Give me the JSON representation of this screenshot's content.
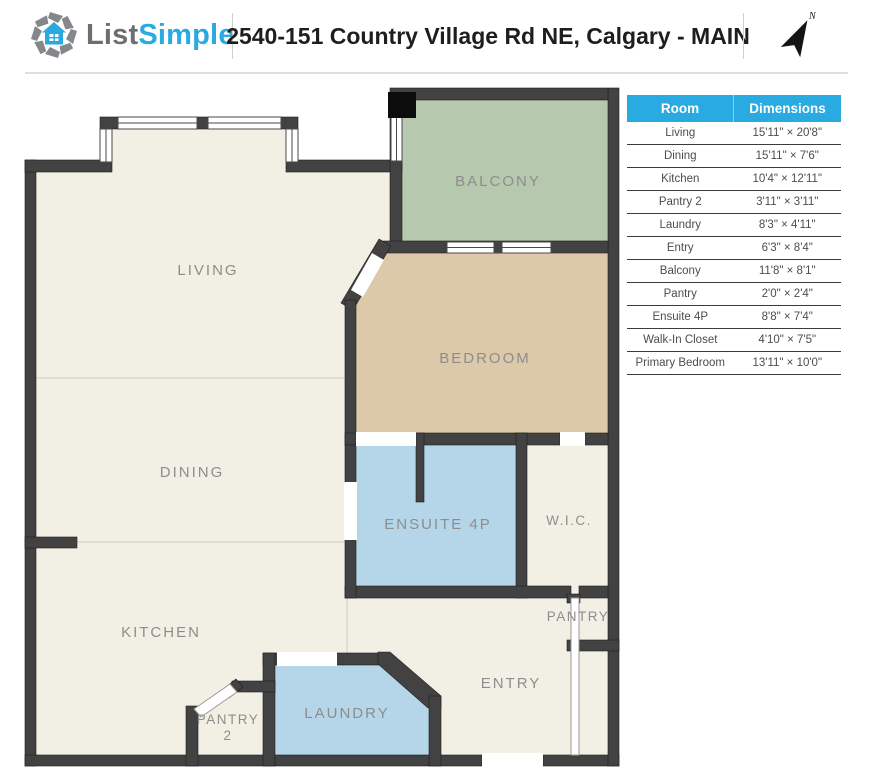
{
  "theme": {
    "accent": "#29abe2",
    "wall": "#424242",
    "floor": "#f2efe5",
    "bedroomcol": "#dcc9a9",
    "balconycol": "#b6c8ae",
    "watercol": "#b5d6e8",
    "labelcol": "#8d8d8d",
    "titlecol": "#1e1e1e",
    "logogray": "#6d6e71"
  },
  "header": {
    "logo_part1": "List",
    "logo_part2": "Simple",
    "title": "2540-151 Country Village Rd NE, Calgary - MAIN",
    "north_label": "N"
  },
  "plan": {
    "rooms": {
      "living": "LIVING",
      "dining": "DINING",
      "kitchen": "KITCHEN",
      "balcony": "BALCONY",
      "bedroom": "BEDROOM",
      "ensuite": "ENSUITE 4P",
      "wic": "W.I.C.",
      "pantry": "PANTRY",
      "entry": "ENTRY",
      "laundry": "LAUNDRY",
      "pantry2_line1": "PANTRY",
      "pantry2_line2": "2"
    }
  },
  "table": {
    "headers": {
      "room": "Room",
      "dimensions": "Dimensions"
    },
    "rows": [
      {
        "room": "Living",
        "dims": "15'11\" × 20'8\""
      },
      {
        "room": "Dining",
        "dims": "15'11\" × 7'6\""
      },
      {
        "room": "Kitchen",
        "dims": "10'4\" × 12'11\""
      },
      {
        "room": "Pantry 2",
        "dims": "3'11\" × 3'11\""
      },
      {
        "room": "Laundry",
        "dims": "8'3\" × 4'11\""
      },
      {
        "room": "Entry",
        "dims": "6'3\" × 8'4\""
      },
      {
        "room": "Balcony",
        "dims": "11'8\" × 8'1\""
      },
      {
        "room": "Pantry",
        "dims": "2'0\" × 2'4\""
      },
      {
        "room": "Ensuite 4P",
        "dims": "8'8\" × 7'4\""
      },
      {
        "room": "Walk-In Closet",
        "dims": "4'10\" × 7'5\""
      },
      {
        "room": "Primary Bedroom",
        "dims": "13'11\" × 10'0\""
      }
    ]
  }
}
